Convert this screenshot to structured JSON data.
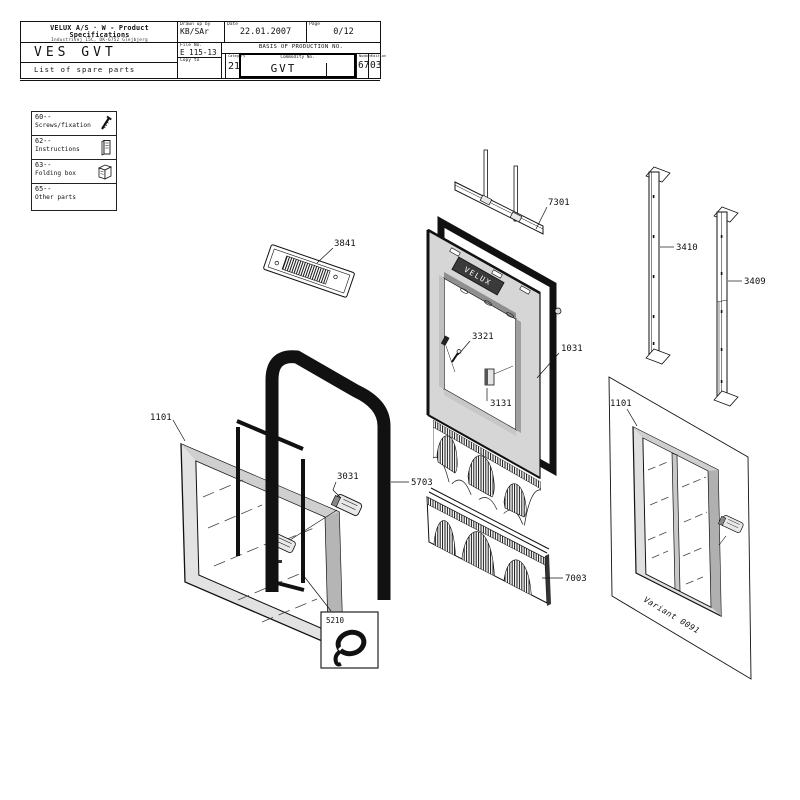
{
  "header": {
    "company_line": "VELUX A/S · W - Product Specifications",
    "address_line": "Industrivej 15C, DK-6752 Glejbjerg",
    "product": "VES GVT",
    "subtitle": "List of spare parts",
    "drawn_label": "Drawn up by",
    "drawn_value": "KB/SAr",
    "date_label": "Date",
    "date_value": "22.01.2007",
    "page_label": "Page",
    "page_value": "0/12",
    "file_label": "File No.",
    "file_value": "E 115-13",
    "basis_label": "BASIS OF PRODUCTION NO.",
    "copy_label": "Copy to",
    "category_label": "Category",
    "category_value": "21",
    "commodity_label": "Commodity No.",
    "commodity_value": "GVT",
    "number_label": "Number",
    "number_value": "67",
    "edition_label": "Edition",
    "edition_value": "03"
  },
  "legend": {
    "rows": [
      {
        "code": "60--",
        "label": "Screws/fixation",
        "icon": "screw-icon"
      },
      {
        "code": "62--",
        "label": "Instructions",
        "icon": "booklet-icon"
      },
      {
        "code": "63--",
        "label": "Folding box",
        "icon": "box-icon"
      },
      {
        "code": "65--",
        "label": "Other parts",
        "icon": ""
      }
    ]
  },
  "diagram": {
    "logo_text": "VELUX",
    "variant_note": "Variant 0091",
    "labels": {
      "vent_plate": "3841",
      "bar": "7301",
      "rail_left": "3410",
      "rail_right": "3409",
      "pin": "3321",
      "frame": "1031",
      "bracket": "3131",
      "sash": "1101",
      "latch": "3031",
      "seal_arch": "5703",
      "cord": "5210",
      "pleated": "7003",
      "variant_sash": "1101"
    }
  },
  "colors": {
    "line": "#111111",
    "fill_light": "#d6d6d6",
    "fill_mid": "#9f9f9f",
    "fill_dark": "#2b2b2b"
  }
}
